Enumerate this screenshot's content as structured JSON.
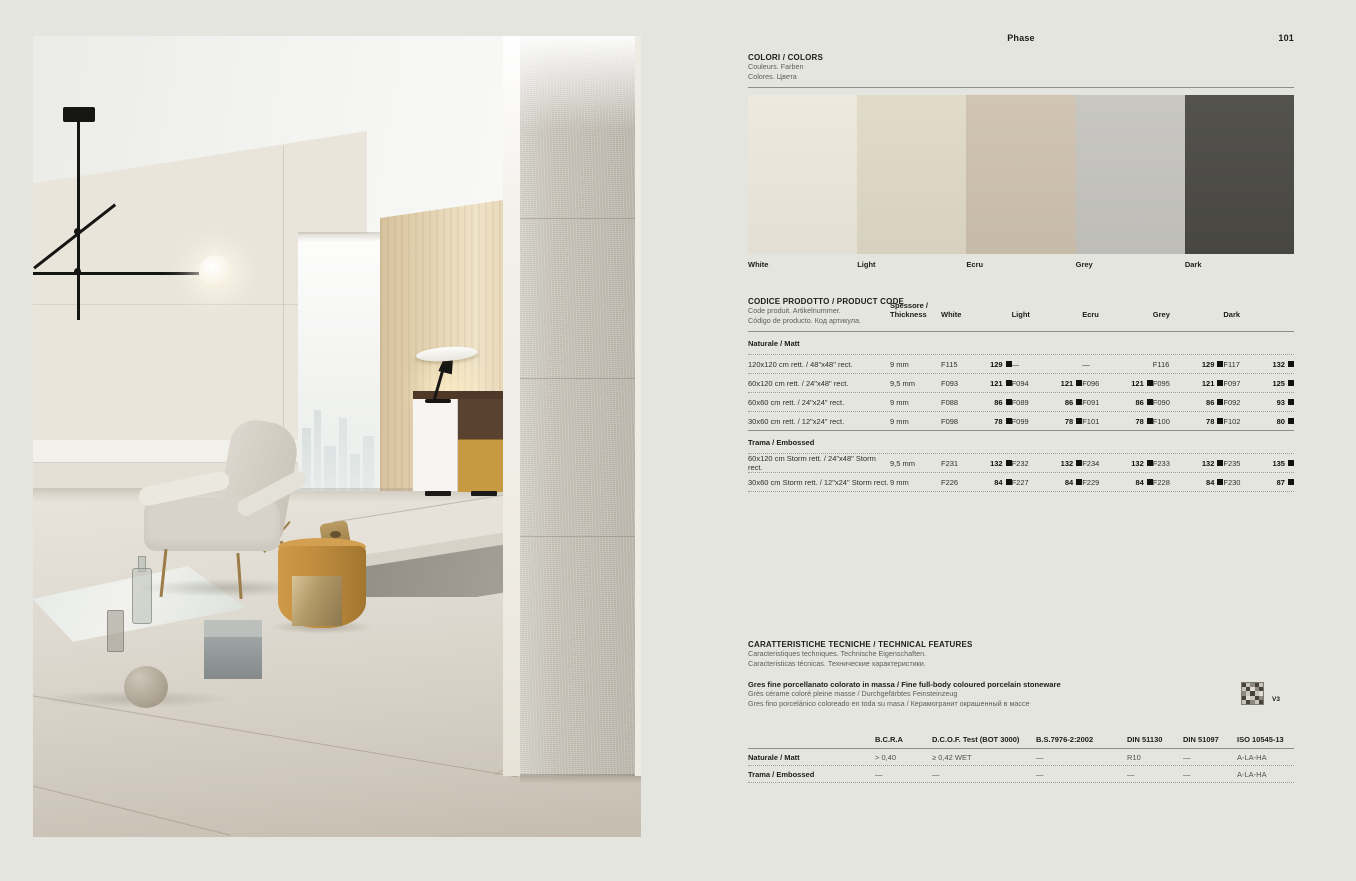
{
  "page": {
    "title": "Phase",
    "number": "101"
  },
  "colors": {
    "title": "COLORI / COLORS",
    "sub1": "Couleurs. Farben",
    "sub2": "Colores. Цвета",
    "swatches": [
      {
        "name": "White",
        "hex": "#ece8dd"
      },
      {
        "name": "Light",
        "hex": "#e0d9c7"
      },
      {
        "name": "Ecru",
        "hex": "#cec1af"
      },
      {
        "name": "Grey",
        "hex": "#c5c4bf"
      },
      {
        "name": "Dark",
        "hex": "#4a4944"
      }
    ]
  },
  "pc": {
    "title": "CODICE PRODOTTO / PRODUCT CODE",
    "sub1": "Code produit. Artikelnummer.",
    "sub2": "Código de producto. Код артикула.",
    "thickness_l1": "Spessore /",
    "thickness_l2": "Thickness",
    "columns": [
      "White",
      "Light",
      "Ecru",
      "Grey",
      "Dark"
    ],
    "groups": [
      {
        "name": "Naturale / Matt",
        "rows": [
          {
            "size": "120x120 cm rett. / 48\"x48\" rect.",
            "thickness": "9 mm",
            "cells": [
              {
                "code": "F115",
                "price": "129"
              },
              {
                "code": "—",
                "price": ""
              },
              {
                "code": "—",
                "price": ""
              },
              {
                "code": "F116",
                "price": "129"
              },
              {
                "code": "F117",
                "price": "132"
              }
            ]
          },
          {
            "size": "60x120 cm rett. / 24\"x48\" rect.",
            "thickness": "9,5 mm",
            "cells": [
              {
                "code": "F093",
                "price": "121"
              },
              {
                "code": "F094",
                "price": "121"
              },
              {
                "code": "F096",
                "price": "121"
              },
              {
                "code": "F095",
                "price": "121"
              },
              {
                "code": "F097",
                "price": "125"
              }
            ]
          },
          {
            "size": "60x60 cm rett. / 24\"x24\" rect.",
            "thickness": "9 mm",
            "cells": [
              {
                "code": "F088",
                "price": "86"
              },
              {
                "code": "F089",
                "price": "86"
              },
              {
                "code": "F091",
                "price": "86"
              },
              {
                "code": "F090",
                "price": "86"
              },
              {
                "code": "F092",
                "price": "93"
              }
            ]
          },
          {
            "size": "30x60 cm rett. / 12\"x24\" rect.",
            "thickness": "9 mm",
            "cells": [
              {
                "code": "F098",
                "price": "78"
              },
              {
                "code": "F099",
                "price": "78"
              },
              {
                "code": "F101",
                "price": "78"
              },
              {
                "code": "F100",
                "price": "78"
              },
              {
                "code": "F102",
                "price": "80"
              }
            ]
          }
        ]
      },
      {
        "name": "Trama / Embossed",
        "rows": [
          {
            "size": "60x120 cm Storm rett. / 24\"x48\" Storm rect.",
            "thickness": "9,5 mm",
            "cells": [
              {
                "code": "F231",
                "price": "132"
              },
              {
                "code": "F232",
                "price": "132"
              },
              {
                "code": "F234",
                "price": "132"
              },
              {
                "code": "F233",
                "price": "132"
              },
              {
                "code": "F235",
                "price": "135"
              }
            ]
          },
          {
            "size": "30x60 cm Storm rett. / 12\"x24\" Storm rect.",
            "thickness": "9 mm",
            "cells": [
              {
                "code": "F226",
                "price": "84"
              },
              {
                "code": "F227",
                "price": "84"
              },
              {
                "code": "F229",
                "price": "84"
              },
              {
                "code": "F228",
                "price": "84"
              },
              {
                "code": "F230",
                "price": "87"
              }
            ]
          }
        ]
      }
    ]
  },
  "tech": {
    "title": "CARATTERISTICHE TECNICHE / TECHNICAL FEATURES",
    "sub1": "Caracteristiques techniques. Technische Eigenschaften.",
    "sub2": "Caracteristicas técnicas. Технические характеристики.",
    "material": "Gres fine porcellanato colorato in massa / Fine full-body coloured porcelain stoneware",
    "material_sub1": "Grès cérame coloré pleine masse / Durchgefärbtes Feinsteinzeug",
    "material_sub2": "Gres fino porcelánico coloreado en toda su masa / Керамогранит окрашенный в массе",
    "variation": "V3",
    "table": {
      "headers": [
        "B.C.R.A",
        "D.C.O.F. Test (BOT 3000)",
        "B.S.7976-2:2002",
        "DIN 51130",
        "DIN 51097",
        "ISO 10545-13"
      ],
      "rows": [
        {
          "label": "Naturale / Matt",
          "values": [
            "> 0,40",
            "≥ 0,42 WET",
            "—",
            "R10",
            "—",
            "A-LA-HA"
          ]
        },
        {
          "label": "Trama / Embossed",
          "values": [
            "—",
            "—",
            "—",
            "—",
            "—",
            "A-LA-HA"
          ]
        }
      ]
    }
  },
  "photo_palette": {
    "wall": "#e9e5da",
    "wood_wall": "#e4d3b2",
    "floor": "#ded9d0",
    "embossed_pillar": "#ccc8be",
    "pouf_accent": "#bf8c3e",
    "mustard_drawer": "#c59a41"
  }
}
